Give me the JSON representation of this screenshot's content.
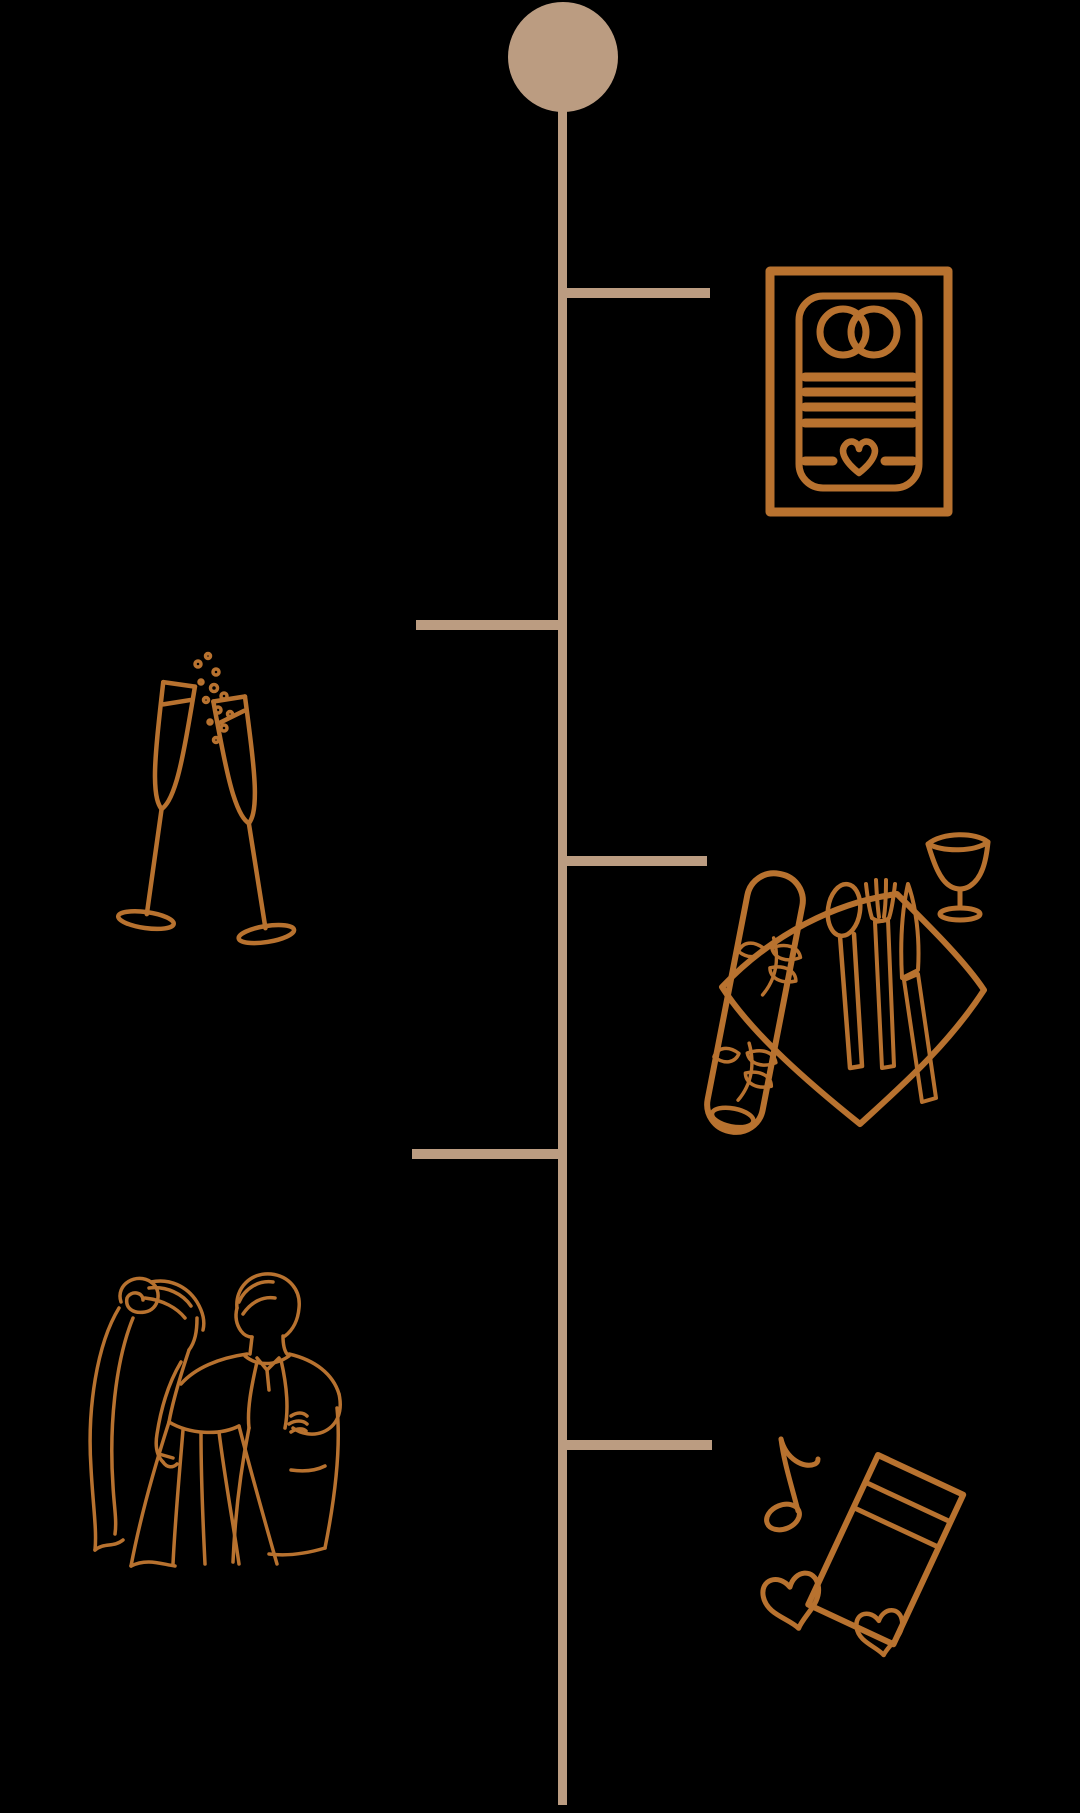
{
  "canvas": {
    "width_px": 1080,
    "height_px": 1813
  },
  "colors": {
    "background": "#000000",
    "timeline": "#BB9C81",
    "icon": "#B8722F"
  },
  "timeline": {
    "orientation": "vertical",
    "start_marker": "filled-circle",
    "branch_count": 5,
    "events": [
      {
        "position": 1,
        "side": "right",
        "icon": "wedding-invitation-icon"
      },
      {
        "position": 2,
        "side": "left",
        "icon": "champagne-toast-icon"
      },
      {
        "position": 3,
        "side": "right",
        "icon": "table-setting-icon"
      },
      {
        "position": 4,
        "side": "left",
        "icon": "first-dance-icon"
      },
      {
        "position": 5,
        "side": "right",
        "icon": "music-hearts-icon"
      }
    ]
  }
}
